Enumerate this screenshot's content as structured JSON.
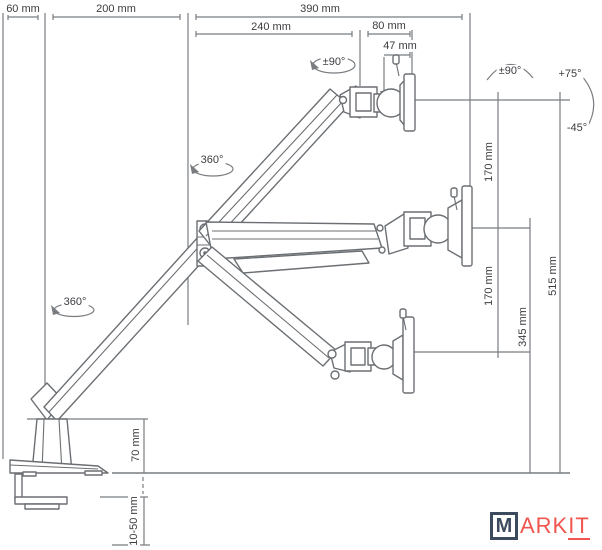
{
  "dims": {
    "d60": "60 mm",
    "d200": "200 mm",
    "d390": "390 mm",
    "d240": "240 mm",
    "d80": "80 mm",
    "d47": "47 mm",
    "d170a": "170 mm",
    "d170b": "170 mm",
    "d345": "345 mm",
    "d515": "515 mm",
    "d70": "70 mm",
    "d1050": "10-50 mm"
  },
  "angles": {
    "head_rotation": "±90°",
    "swivel": "±90°",
    "tilt_up": "+75°",
    "tilt_down": "-45°",
    "elbow_rotation": "360°",
    "base_rotation": "360°"
  },
  "logo": {
    "m": "M",
    "ark": "ARK",
    "it": "IT"
  },
  "colors": {
    "line": "#6b6f73",
    "dimension_line": "#797d81",
    "text": "#3c3c41",
    "logo_navy": "#3d4b5f",
    "logo_red": "#f0564f"
  }
}
